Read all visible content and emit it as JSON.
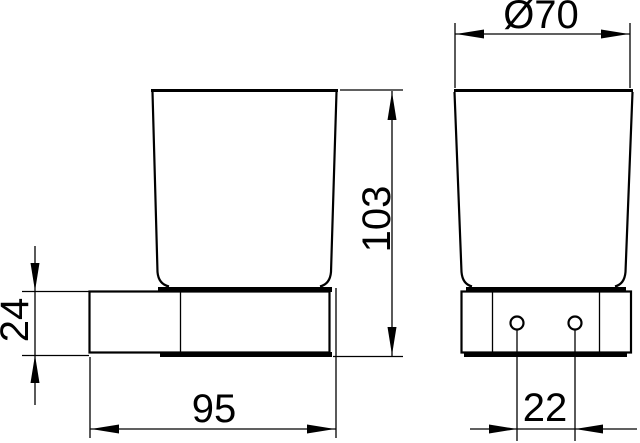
{
  "colors": {
    "background": "#ffffff",
    "line": "#000000"
  },
  "dimensions": {
    "diameter": "Ø70",
    "height": "103",
    "depth": "95",
    "holder_height": "24",
    "hole_spacing": "22"
  }
}
